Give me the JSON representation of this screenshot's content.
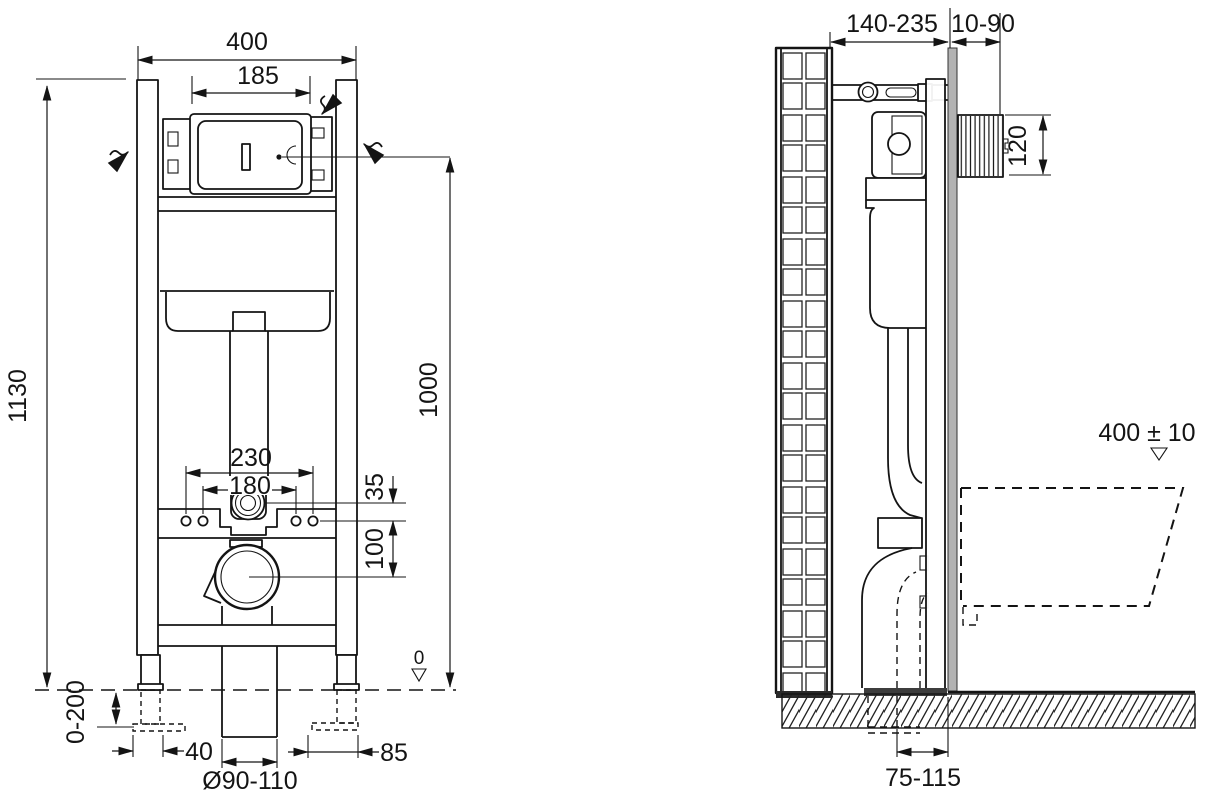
{
  "drawing_title": "concealed-wc-frame-installation-dimensions",
  "front_view": {
    "overall_width": "400",
    "plate_opening_width": "185",
    "overall_height": "1130",
    "flush_plate_center_height": "1000",
    "outer_fixing_spacing": "230",
    "inner_fixing_spacing": "180",
    "flush_bend_offset": "35",
    "drain_center_offset": "100",
    "floor_level_marker": "0",
    "foot_adjustment_range": "0-200",
    "left_foot_dim": "40",
    "right_foot_dim": "85",
    "drain_pipe_diameter": "Ø90-110"
  },
  "side_view": {
    "frame_depth_range": "140-235",
    "wall_finish_depth_range": "10-90",
    "access_opening_height": "120",
    "bowl_rim_height": "400 ± 10",
    "drain_to_wall_distance": "75-115"
  }
}
